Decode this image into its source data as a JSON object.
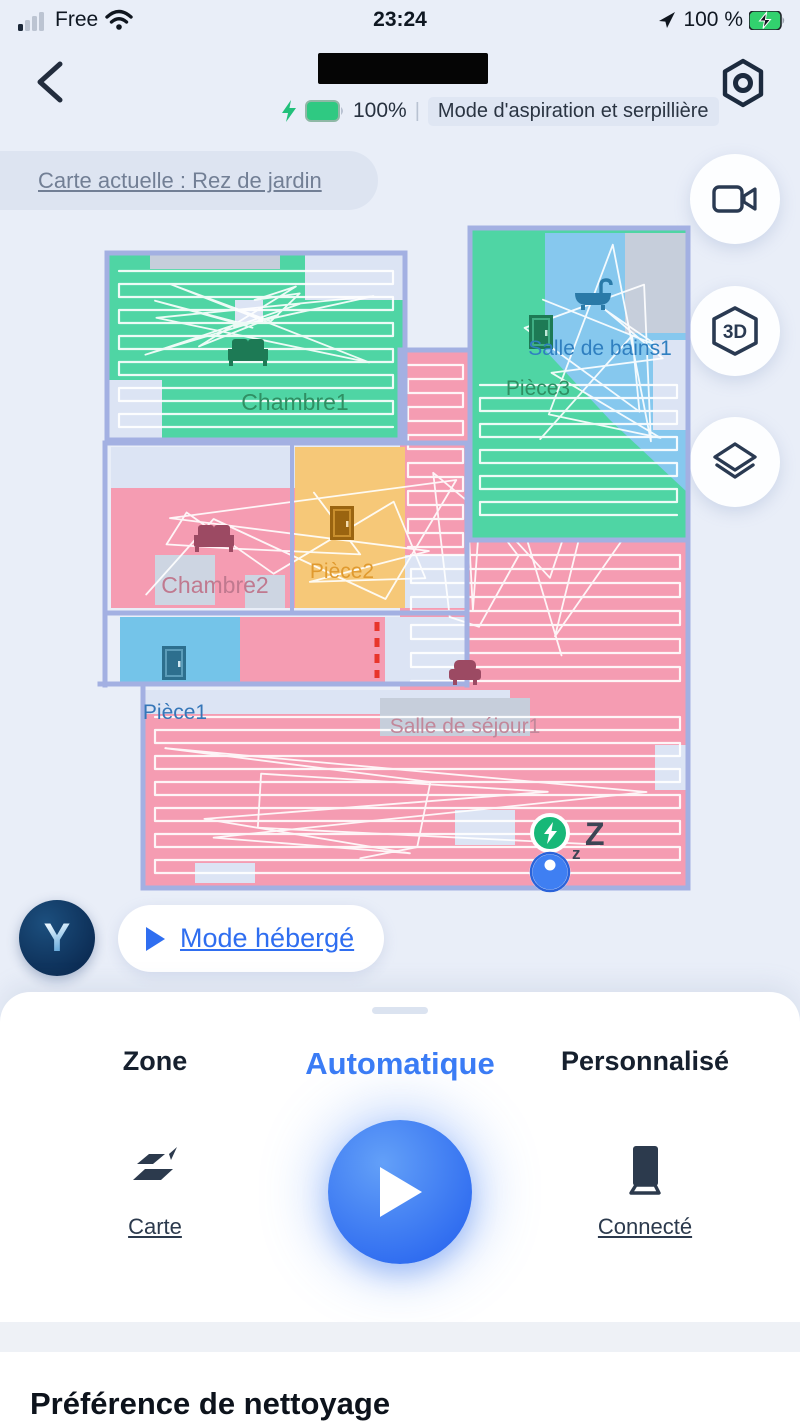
{
  "status_bar": {
    "carrier": "Free",
    "time": "23:24",
    "battery_percent": "100 %"
  },
  "header": {
    "robot_battery": "100%",
    "divider": "|",
    "mode": "Mode d'aspiration et serpillière"
  },
  "map_bar": {
    "label": "Carte actuelle : Rez de jardin"
  },
  "side_buttons": {
    "three_d_label": "3D"
  },
  "map": {
    "rooms": [
      {
        "id": "chambre1",
        "label": "Chambre1",
        "color": "#4fd5a4",
        "label_color": "#2f8f63"
      },
      {
        "id": "salle-de-bains1",
        "label": "Salle de bains1",
        "color": "#86c8ee",
        "label_color": "#2f7fc0"
      },
      {
        "id": "piece3",
        "label": "Pièce3",
        "color": "#4fd5a4",
        "label_color": "#2f8f63"
      },
      {
        "id": "chambre2",
        "label": "Chambre2",
        "color": "#f59cb2",
        "label_color": "#c0798f"
      },
      {
        "id": "piece2",
        "label": "Pièce2",
        "color": "#f6c878",
        "label_color": "#e09a2f"
      },
      {
        "id": "piece1",
        "label": "Pièce1",
        "color": "#74c4e9",
        "label_color": "#3576b8"
      },
      {
        "id": "salle-de-sejour1",
        "label": "Salle de séjour1",
        "color": "#f59cb2",
        "label_color": "#c2879a"
      }
    ],
    "sleep_small": "z",
    "sleep_big": "Z"
  },
  "hosted_mode": {
    "label": "Mode hébergé"
  },
  "sheet": {
    "tabs": [
      {
        "label": "Zone",
        "active": false
      },
      {
        "label": "Automatique",
        "active": true
      },
      {
        "label": "Personnalisé",
        "active": false
      }
    ],
    "actions": [
      {
        "label": "Carte"
      },
      {
        "label": "Connecté"
      }
    ]
  },
  "section": {
    "title": "Préférence de nettoyage"
  }
}
